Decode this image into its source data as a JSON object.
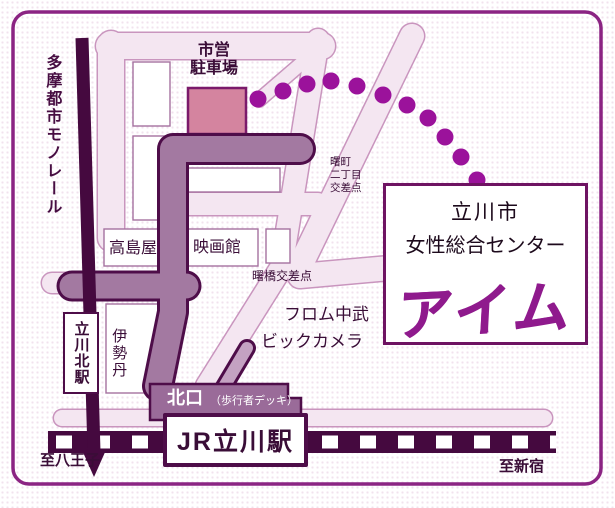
{
  "map": {
    "destination_box": {
      "line1": "立川市",
      "line2": "女性総合センター",
      "logo": "アイム"
    },
    "stations": {
      "jr_tachikawa": "JR立川駅",
      "tachikawa_kita": "立川北駅"
    },
    "monorail_label": "多摩都市モノレール",
    "landmarks": {
      "parking_line1": "市営",
      "parking_line2": "駐車場",
      "takashimaya": "高島屋",
      "cinema": "映画館",
      "isetan": "伊勢丹",
      "from_nakamu": "フロム中武",
      "bic_camera": "ビックカメラ"
    },
    "intersections": {
      "akebonocho_line1": "曙町",
      "akebonocho_line2": "二丁目",
      "akebonocho_line3": "交差点",
      "akebonobashi": "曙橋交差点"
    },
    "exits": {
      "north_exit": "北口",
      "deck_note": "（歩行者デッキ）"
    },
    "directions": {
      "to_hachioji": "至八王子",
      "to_shinjuku": "至新宿"
    },
    "colors": {
      "border": "#8b2483",
      "dark_line": "#4e0d49",
      "route_fill": "#a379a1",
      "deck_fill": "#9a6b99",
      "street_fill": "#f4e6f1",
      "street_outline": "#c995be",
      "parking_fill": "#d4849f",
      "dots": "#9b129b",
      "logo_purple": "#8f1a8d",
      "text": "#3a0d37"
    }
  }
}
